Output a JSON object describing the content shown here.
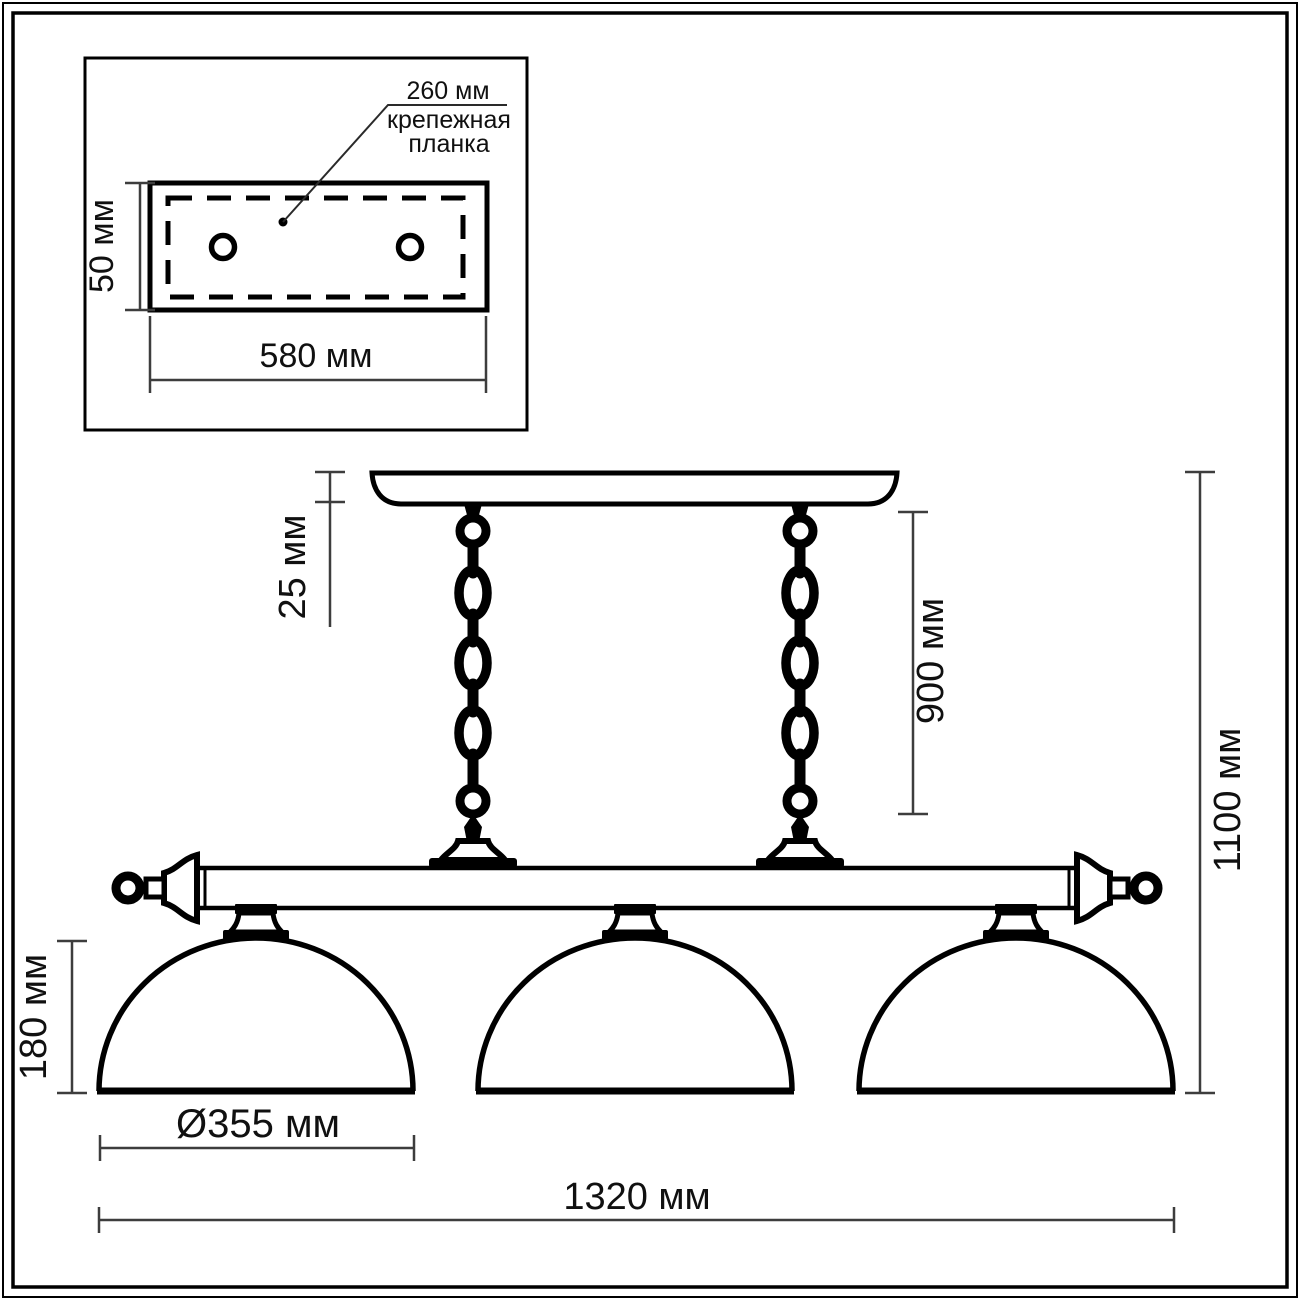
{
  "drawing": {
    "type": "technical-dimension-drawing",
    "subject": "three-shade billiard pendant light fixture",
    "inset": {
      "hole_spacing_label": "260 мм",
      "caption_line1": "крепежная",
      "caption_line2": "планка",
      "plate_height_label": "50 мм",
      "plate_width_label": "580 мм"
    },
    "dimensions": {
      "canopy_height": "25 мм",
      "chain_length": "900 мм",
      "overall_height": "1100 мм",
      "shade_height": "180 мм",
      "shade_diameter": "Ø355 мм",
      "overall_width": "1320 мм"
    },
    "colors": {
      "line": "#000000",
      "dimension": "#3d3d3d",
      "background": "#ffffff"
    }
  }
}
